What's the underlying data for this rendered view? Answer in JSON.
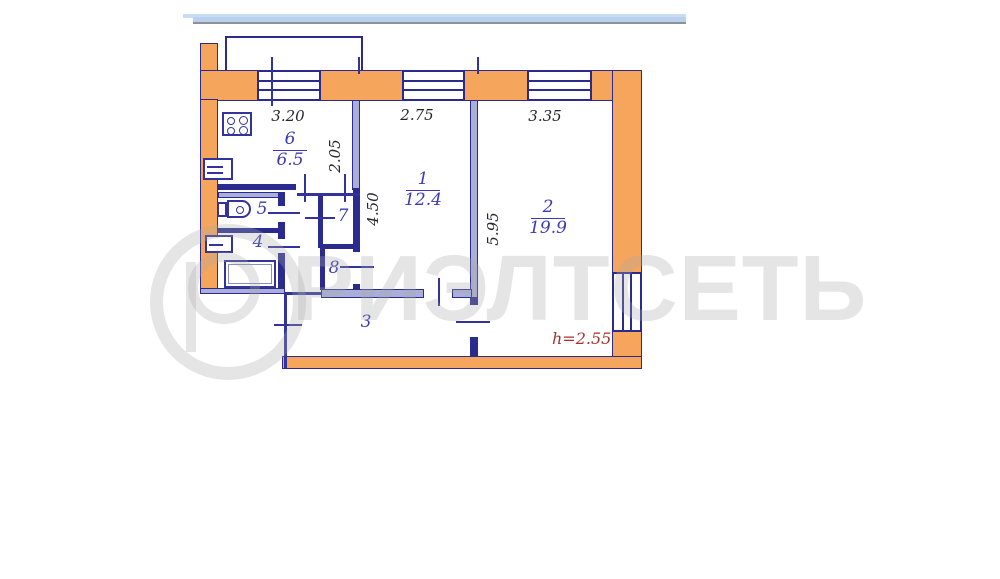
{
  "plan_title": "apartment-floor-plan",
  "rooms": {
    "r1": {
      "number": "1",
      "area": "12.4"
    },
    "r2": {
      "number": "2",
      "area": "19.9"
    },
    "r3": {
      "number": "3"
    },
    "r4": {
      "number": "4"
    },
    "r5": {
      "number": "5"
    },
    "r6": {
      "number": "6",
      "area": "6.5"
    },
    "r7": {
      "number": "7"
    },
    "r8": {
      "number": "8"
    }
  },
  "dimensions": {
    "kitchen_width": "3.20",
    "room1_width": "2.75",
    "room2_width": "3.35",
    "kitchen_depth": "2.05",
    "room1_depth": "4.50",
    "room2_depth": "5.95",
    "ceiling_height": "h=2.55"
  },
  "watermark": {
    "text": "РИЭЛТСЕТЬ",
    "logo": "realty-network-logo"
  },
  "icons": {
    "stove": "stove-icon",
    "kitchen_sink": "kitchen-sink-icon",
    "toilet": "toilet-icon",
    "washbasin": "washbasin-icon",
    "bathtub": "bathtub-icon"
  },
  "colors": {
    "wall_fill": "#F5A55C",
    "wall_line": "#2B2B8F",
    "partition_fill": "#A9AFD8",
    "room_label": "#3A3AB4",
    "dimension_text": "#26262E",
    "height_text": "#A2342E",
    "header_bar": "#B9D1EE",
    "watermark_gray": "#ECECEC"
  }
}
